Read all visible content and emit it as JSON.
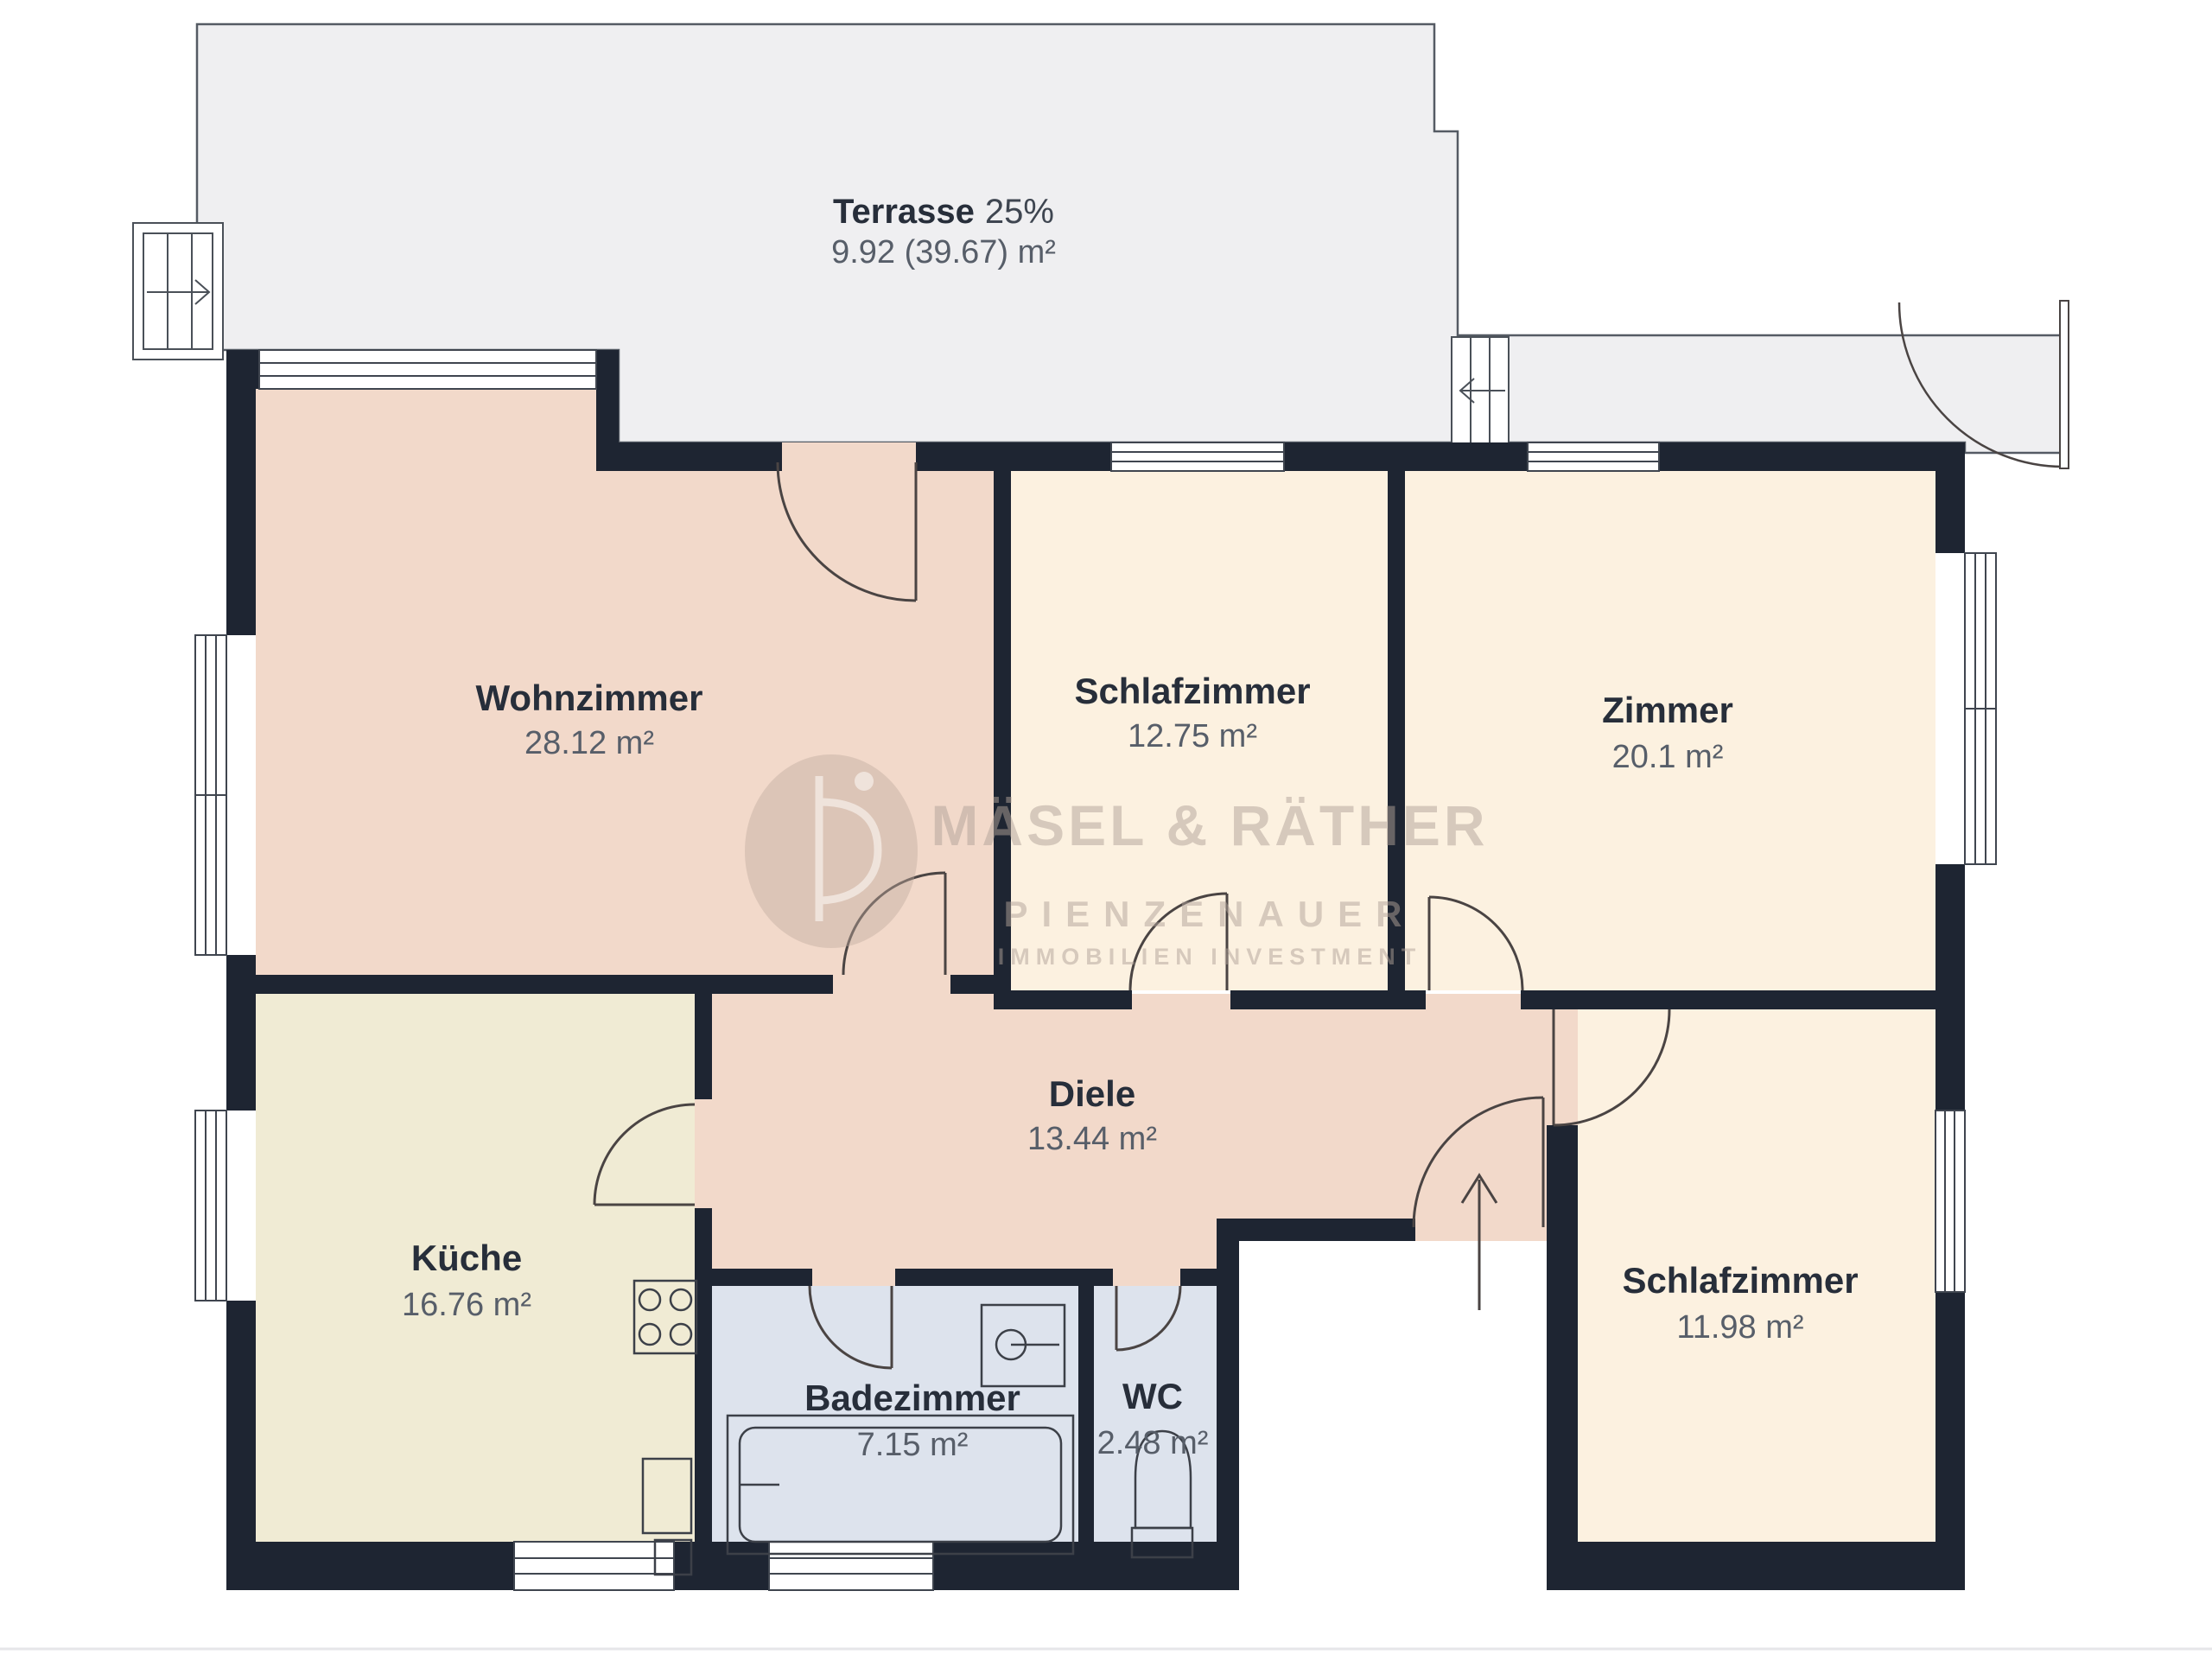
{
  "plan_title": "floor-plan",
  "terrace": {
    "name": "Terrasse",
    "percent": "25%",
    "area": "9.92 (39.67) m²"
  },
  "rooms": [
    {
      "id": "wohnzimmer",
      "name": "Wohnzimmer",
      "area": "28.12 m²"
    },
    {
      "id": "schlafzimmer-1",
      "name": "Schlafzimmer",
      "area": "12.75 m²"
    },
    {
      "id": "zimmer",
      "name": "Zimmer",
      "area": "20.1 m²"
    },
    {
      "id": "diele",
      "name": "Diele",
      "area": "13.44 m²"
    },
    {
      "id": "kueche",
      "name": "Küche",
      "area": "16.76 m²"
    },
    {
      "id": "badezimmer",
      "name": "Badezimmer",
      "area": "7.15 m²"
    },
    {
      "id": "wc",
      "name": "WC",
      "area": "2.48 m²"
    },
    {
      "id": "schlafzimmer-2",
      "name": "Schlafzimmer",
      "area": "11.98 m²"
    }
  ],
  "watermark": {
    "line1": "MÄSEL & RÄTHER",
    "line2": "PIENZENAUER",
    "line3": "IMMOBILIEN INVESTMENT",
    "monogram": "P"
  },
  "palette": {
    "wall": "#1e2532",
    "terrace_fill": "#efeff1",
    "living_pink": "#f2d9ca",
    "bedroom_cream": "#fcf1e0",
    "kitchen_cream": "#f0ebd4",
    "bath_blue": "#dde3ed",
    "label_dark": "#272e3a",
    "label_grey": "#575e69",
    "watermark": "#b1a399"
  }
}
